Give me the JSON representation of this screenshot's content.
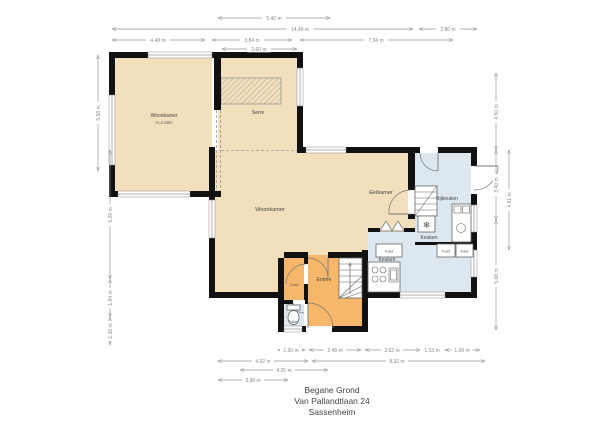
{
  "palette": {
    "wall": "#111111",
    "room_living": "#f2dfbc",
    "room_hall": "#f6b76a",
    "room_service": "#dce7f0",
    "dim_line": "#999999",
    "dim_text": "#8a8a8a",
    "label_text": "#444444",
    "fixture_stroke": "#666666"
  },
  "title": {
    "floor": "Begane Grond",
    "address": "Van Pallandtlaan 24",
    "city": "Sassenheim"
  },
  "rooms": {
    "woonkamer_voor": "Woonkamer",
    "woonkamer_voor_height": "H=2.58m",
    "serre": "Serre",
    "eetkamer": "Eetkamer",
    "woonkamer": "Woonkamer",
    "bijkeuken": "Bijkeuken",
    "keuken_boven": "Keuken",
    "keuken_onder": "Keuken",
    "entree": "Entree",
    "kast_hal": "Kast",
    "toilet": "Toilet",
    "kast_1": "Kast",
    "kast_2": "Kast",
    "kast_3": "Kast"
  },
  "dims": {
    "top_540": "5.40 m",
    "top_1448": "14.48 m",
    "top_280": "2.80 m",
    "top_448": "4.48 m",
    "top_384": "3.84 m",
    "top_734": "7.34 m",
    "top_360": "3.60 m",
    "bottom_130": "1.30 m",
    "bottom_248": "2.48 m",
    "bottom_262": "2.62 m",
    "bottom_103": "1.03 m",
    "bottom_168": "1.68 m",
    "bottom_432": "4.32 m",
    "bottom_832": "8.32 m",
    "bottom_425": "4.25 m",
    "bottom_338": "3.38 m",
    "left_558": "5.58 m",
    "left_620": "6.20 m",
    "left_184": "1.84 m",
    "left_136": "1.36 m",
    "right_450": "4.50 m",
    "right_340": "3.40 m",
    "right_568": "5.68 m",
    "right_481": "4.81 m"
  },
  "icons": {
    "snowflake": "❄"
  }
}
